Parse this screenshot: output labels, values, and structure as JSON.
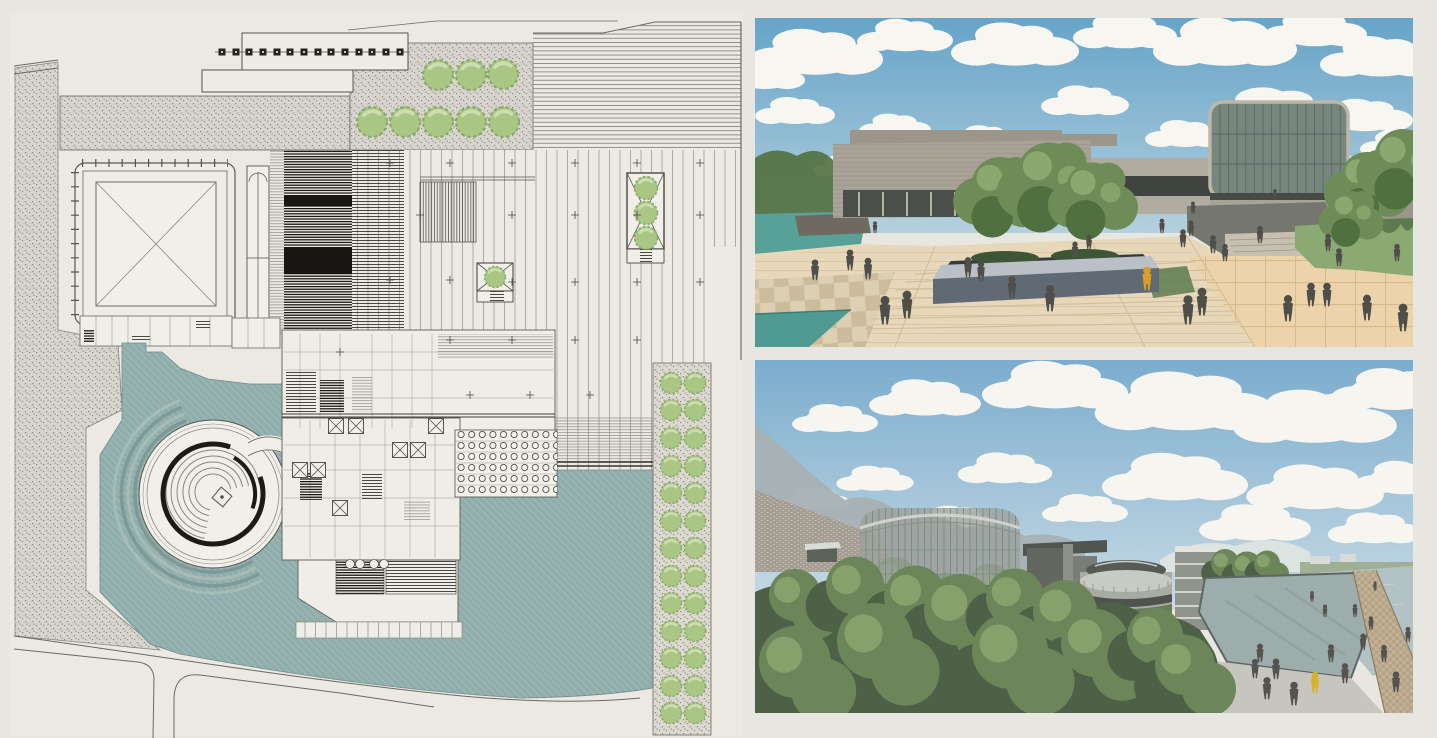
{
  "page": {
    "background": "#e8e6e0",
    "label": "architecture presentation board with site plan and two renderings"
  },
  "plan": {
    "label": "site-plan-drawing",
    "colors": {
      "paper": "#ebe9e2",
      "interior": "#f1efe9",
      "line": "#55534e",
      "line_soft": "#8a8780",
      "dark": "#1c1b16",
      "gravel": "#d8d5ce",
      "gravel_dot": "#8d8a82",
      "water": "#8fadaa",
      "water_edge": "#6e8b88",
      "ring": "#7d9a96",
      "ring_light": "#a8bcb6",
      "tree": "#a9c685",
      "tree_dark": "#7fa35c",
      "tree_light": "#cfdfb2",
      "road": "#6b6963"
    },
    "canopy_posts": [
      [
        222,
        52
      ],
      [
        236,
        52
      ],
      [
        249,
        52
      ],
      [
        263,
        52
      ],
      [
        277,
        52
      ],
      [
        290,
        52
      ],
      [
        304,
        52
      ],
      [
        318,
        52
      ],
      [
        331,
        52
      ],
      [
        345,
        52
      ],
      [
        359,
        52
      ],
      [
        372,
        52
      ],
      [
        386,
        52
      ],
      [
        400,
        52
      ]
    ],
    "trees_plaza_row1": [
      [
        438,
        75,
        1.5
      ],
      [
        471,
        75,
        1.5
      ],
      [
        503,
        74,
        1.5
      ]
    ],
    "trees_plaza_row2": [
      [
        372,
        122,
        1.5
      ],
      [
        405,
        122,
        1.5
      ],
      [
        438,
        122,
        1.5
      ],
      [
        471,
        122,
        1.5
      ],
      [
        504,
        122,
        1.5
      ]
    ],
    "trees_planters": [
      [
        646,
        188,
        1.15
      ],
      [
        646,
        213,
        1.15
      ],
      [
        646,
        238,
        1.15
      ],
      [
        495,
        277,
        1.05
      ]
    ],
    "trees_east_row": [
      [
        671,
        383,
        1.05
      ],
      [
        695,
        383,
        1.05
      ],
      [
        671,
        410,
        1.05
      ],
      [
        695,
        410,
        1.05
      ],
      [
        671,
        438,
        1.05
      ],
      [
        695,
        438,
        1.05
      ],
      [
        671,
        466,
        1.05
      ],
      [
        695,
        466,
        1.05
      ],
      [
        671,
        493,
        1.05
      ],
      [
        695,
        493,
        1.05
      ],
      [
        671,
        521,
        1.05
      ],
      [
        695,
        521,
        1.05
      ],
      [
        671,
        548,
        1.05
      ],
      [
        695,
        548,
        1.05
      ],
      [
        671,
        576,
        1.05
      ],
      [
        695,
        576,
        1.05
      ],
      [
        671,
        603,
        1.05
      ],
      [
        695,
        603,
        1.05
      ],
      [
        671,
        631,
        1.05
      ],
      [
        695,
        631,
        1.05
      ],
      [
        671,
        658,
        1.05
      ],
      [
        695,
        658,
        1.05
      ],
      [
        671,
        686,
        1.05
      ],
      [
        695,
        686,
        1.05
      ],
      [
        671,
        713,
        1.05
      ],
      [
        695,
        713,
        1.05
      ]
    ],
    "xboxes": [
      [
        336,
        426
      ],
      [
        356,
        426
      ],
      [
        400,
        450
      ],
      [
        418,
        450
      ],
      [
        436,
        426
      ],
      [
        300,
        470
      ],
      [
        318,
        470
      ],
      [
        340,
        508
      ]
    ],
    "plus_marks": [
      [
        390,
        163
      ],
      [
        450,
        163
      ],
      [
        512,
        163
      ],
      [
        575,
        163
      ],
      [
        637,
        163
      ],
      [
        700,
        163
      ],
      [
        420,
        215
      ],
      [
        512,
        215
      ],
      [
        575,
        215
      ],
      [
        637,
        215
      ],
      [
        700,
        215
      ],
      [
        390,
        280
      ],
      [
        450,
        280
      ],
      [
        512,
        282
      ],
      [
        575,
        282
      ],
      [
        637,
        282
      ],
      [
        700,
        282
      ],
      [
        450,
        340
      ],
      [
        512,
        340
      ],
      [
        575,
        340
      ],
      [
        637,
        340
      ],
      [
        470,
        395
      ],
      [
        530,
        395
      ],
      [
        590,
        395
      ],
      [
        340,
        352
      ]
    ]
  },
  "photo_top": {
    "label": "plaza-perspective-rendering",
    "colors": {
      "sky_top": "#66a4c8",
      "sky_bottom": "#b5d0de",
      "cloud": "#f8f6f0",
      "building": "#a8a297",
      "building_top": "#9b958a",
      "building_light": "#b1aca0",
      "soffit": "#4b4f49",
      "glass_col": "#cfc9ba",
      "window_band": "#3f4440",
      "tower_glass": "#77877f",
      "tower_frame": "#bcb7a9",
      "tower_mullion": "#5a6a64",
      "pond": "#57a198",
      "pool": "#4f9b93",
      "lawn": "#8aa973",
      "lawn_dark": "#5d7a4e",
      "plaza": "#e7d8ba",
      "plaza_line": "#cfbe9d",
      "tile_warm": "#ecd3a9",
      "planter_rim": "#b9c0c7",
      "planter_face": "#5f6a74",
      "planter_inner": "#343a40",
      "hedge": "#3e5538",
      "tree": "#6d8c58",
      "tree_dark": "#51703f",
      "tree_light": "#8fae74",
      "ramp_dark": "#75766e",
      "steps_light": "#c6c0b1",
      "figure": "#504e49",
      "accent": "#d8a125"
    },
    "clouds": [
      [
        60,
        38,
        1.7
      ],
      [
        150,
        20,
        1.2
      ],
      [
        260,
        30,
        1.6
      ],
      [
        370,
        16,
        1.3
      ],
      [
        470,
        28,
        1.8
      ],
      [
        560,
        14,
        1.3
      ],
      [
        625,
        42,
        1.5
      ],
      [
        40,
        95,
        1.0
      ],
      [
        140,
        110,
        0.9
      ],
      [
        330,
        85,
        1.1
      ],
      [
        520,
        95,
        1.6
      ],
      [
        610,
        100,
        1.2
      ],
      [
        230,
        120,
        0.8
      ],
      [
        430,
        118,
        1.0
      ],
      [
        90,
        150,
        0.8
      ],
      [
        570,
        148,
        1.1
      ],
      [
        645,
        128,
        1.0
      ],
      [
        10,
        60,
        1.0
      ]
    ],
    "people": [
      [
        95,
        252,
        1.5
      ],
      [
        113,
        261,
        1.55
      ],
      [
        152,
        300,
        2.0
      ],
      [
        130,
        306,
        2.05
      ],
      [
        213,
        259,
        1.45
      ],
      [
        226,
        263,
        1.45
      ],
      [
        295,
        293,
        1.9
      ],
      [
        257,
        280,
        1.6
      ],
      [
        320,
        240,
        1.2
      ],
      [
        334,
        232,
        1.1
      ],
      [
        428,
        229,
        1.3
      ],
      [
        436,
        218,
        1.15
      ],
      [
        458,
        235,
        1.3
      ],
      [
        470,
        243,
        1.25
      ],
      [
        505,
        225,
        1.25
      ],
      [
        407,
        215,
        1.05
      ],
      [
        438,
        196,
        0.9
      ],
      [
        520,
        182,
        0.8
      ],
      [
        573,
        233,
        1.25
      ],
      [
        584,
        248,
        1.3
      ],
      [
        556,
        288,
        1.7
      ],
      [
        572,
        288,
        1.7
      ],
      [
        642,
        243,
        1.25
      ],
      [
        433,
        306,
        2.1
      ],
      [
        447,
        297,
        2.0
      ],
      [
        533,
        303,
        1.9
      ],
      [
        612,
        302,
        1.85
      ],
      [
        648,
        313,
        2.0
      ],
      [
        120,
        215,
        0.85
      ],
      [
        60,
        262,
        1.5
      ]
    ],
    "accent_person": [
      392,
      272,
      1.7
    ]
  },
  "photo_bottom": {
    "label": "aerial-campus-rendering",
    "colors": {
      "sky_top": "#7badce",
      "sky_bottom": "#c8dae4",
      "cloud": "#f7f5ef",
      "mountain": "#a7b1b3",
      "city": "#a49a8e",
      "snow": "#e0e5e1",
      "structure": "#d8dcd6",
      "cylinder": "#9aa39c",
      "cyl_rim": "#cfd3cc",
      "cyl_mullion": "#77817a",
      "slab": "#61665f",
      "slab2": "#787d75",
      "roofplate": "#50554f",
      "drum_body": "#a9aca3",
      "drum_rib": "#c8cbc2",
      "drum_dark": "#4e534d",
      "drum_green": "#6a7c55",
      "parking": "#8f948c",
      "parking_band": "#e3e4dd",
      "hedge": "#4e6344",
      "basin": "#9dadab",
      "basin_edge": "#5d6663",
      "channel": "#b3c2c4",
      "stone": "#c2b194",
      "stone_dot": "#a6957a",
      "plaza": "#c6c5be",
      "trees_front": "#4e6045",
      "tree_mid": "#6d8659",
      "tree_light": "#8fa771",
      "shell": "#b2886a",
      "figure": "#55534f",
      "accent": "#d8b22a"
    },
    "clouds": [
      [
        80,
        60,
        1.0
      ],
      [
        170,
        40,
        1.3
      ],
      [
        300,
        28,
        1.7
      ],
      [
        430,
        45,
        2.1
      ],
      [
        560,
        60,
        1.9
      ],
      [
        640,
        32,
        1.5
      ],
      [
        120,
        120,
        0.9
      ],
      [
        250,
        110,
        1.1
      ],
      [
        420,
        120,
        1.7
      ],
      [
        560,
        130,
        1.6
      ],
      [
        650,
        120,
        1.2
      ],
      [
        200,
        160,
        0.9
      ],
      [
        330,
        150,
        1.0
      ],
      [
        500,
        165,
        1.3
      ],
      [
        620,
        170,
        1.1
      ],
      [
        60,
        140,
        0.8
      ]
    ],
    "people": [
      [
        505,
        302,
        1.35
      ],
      [
        521,
        319,
        1.5
      ],
      [
        539,
        345,
        1.7
      ],
      [
        512,
        339,
        1.6
      ],
      [
        576,
        302,
        1.3
      ],
      [
        590,
        323,
        1.45
      ],
      [
        608,
        290,
        1.2
      ],
      [
        600,
        257,
        0.95
      ],
      [
        616,
        270,
        1.0
      ],
      [
        629,
        302,
        1.25
      ],
      [
        641,
        332,
        1.5
      ],
      [
        653,
        282,
        1.1
      ],
      [
        570,
        257,
        0.9
      ],
      [
        557,
        242,
        0.8
      ],
      [
        620,
        231,
        0.7
      ],
      [
        500,
        318,
        1.4
      ]
    ],
    "accent_person": [
      560,
      333,
      1.55
    ]
  }
}
